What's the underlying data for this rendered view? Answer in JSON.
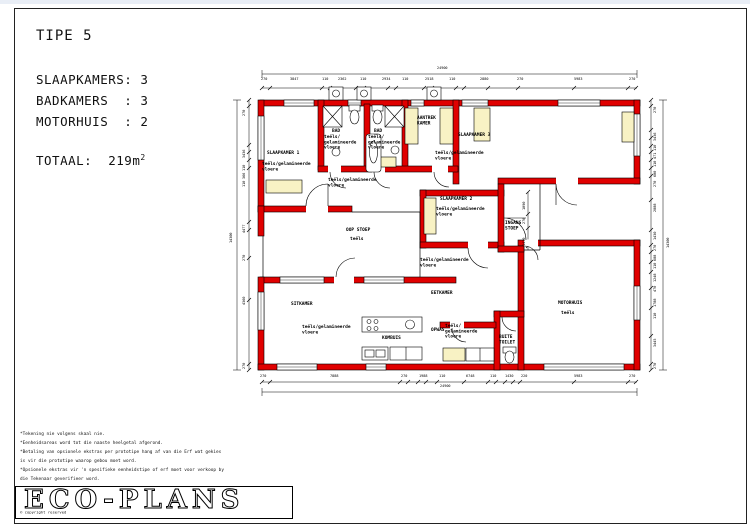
{
  "titleblock": {
    "type_label": "TIPE 5",
    "spec_lines": [
      "SLAAPKAMERS: 3",
      "BADKAMERS  : 3",
      "MOTORHUIS  : 2"
    ],
    "total_label": "TOTAAL:",
    "total_value": "  219m",
    "total_sup": "2"
  },
  "rooms": [
    {
      "name": "SLAAPKAMER 1",
      "floor": "teëls/gelamineerde\nvloere"
    },
    {
      "name": "BAD",
      "floor": "teëls/\ngelamineerde\nvloere"
    },
    {
      "name": "BAD",
      "floor": "teëls/\ngelamineerde\nvloere"
    },
    {
      "name": "AANTREK\nKAMER",
      "floor": ""
    },
    {
      "name": "SLAAPKAMER 3",
      "floor": "teëls/gelamineerde\nvloere"
    },
    {
      "name": "SLAAPKAMER 2",
      "floor": "teëls/gelamineerde\nvloere"
    },
    {
      "name": "OOP STOEP",
      "floor": "teëls"
    },
    {
      "name": "INGANG\nSTOEP",
      "floor": ""
    },
    {
      "name": "EETKAMER",
      "floor": ""
    },
    {
      "name": "SITKAMER",
      "floor": "teëls/gelamineerde\nvloere"
    },
    {
      "name": "KOMBUIS",
      "floor": ""
    },
    {
      "name": "OPWAS",
      "floor": "teëls/\ngelamineerde\nvloere"
    },
    {
      "name": "BUITE\nTOILET",
      "floor": ""
    },
    {
      "name": "MOTORHUIS",
      "floor": "teëls"
    }
  ],
  "floors": {
    "hall": "teëls/gelamineerde\nvloere",
    "living": "teëls/gelamineerde\nvloere"
  },
  "notes": [
    "*Tekening nie volgens skaal nie.",
    "*Eenheidsareas word tot die naaste heelgetal afgerond.",
    "*Betaling van opsionele ekstras per prototipe hang af van die Erf wat gekies",
    "is vir die prototipe waarop gebou moet word.",
    "*Opsionele ekstras vir 'n spesifieke eenheidstipe of erf moet voor verkoop by",
    "die Tekenaar geverifieer word."
  ],
  "logo": {
    "name": "ECO-PLANS",
    "copyright": "© copyright reserved"
  },
  "dims": {
    "top_total": "24900",
    "top": [
      "270",
      "3847",
      "110",
      "2362",
      "110",
      "2934",
      "110",
      "2518",
      "110",
      "2880",
      "270",
      "5983",
      "270"
    ],
    "bottom_total": "24900",
    "bottom": [
      "270",
      "7888",
      "270",
      "1988",
      "110",
      "6748",
      "110",
      "1430",
      "220",
      "5983",
      "270"
    ],
    "left_total": "14300",
    "left": [
      "270",
      "3436",
      "110",
      "366",
      "110",
      "4477",
      "270",
      "4360",
      "270"
    ],
    "right_total": "14300",
    "right": [
      "270",
      "3436",
      "110",
      "471",
      "110",
      "600",
      "270",
      "2888",
      "1430",
      "270",
      "688",
      "110",
      "1248",
      "470",
      "1788",
      "110",
      "3445",
      "270"
    ],
    "inner": [
      "1090",
      "270",
      "1430"
    ]
  },
  "colors": {
    "wall": "#e00000",
    "cupboard": "#f8f2c4",
    "paper": "#ffffff"
  }
}
